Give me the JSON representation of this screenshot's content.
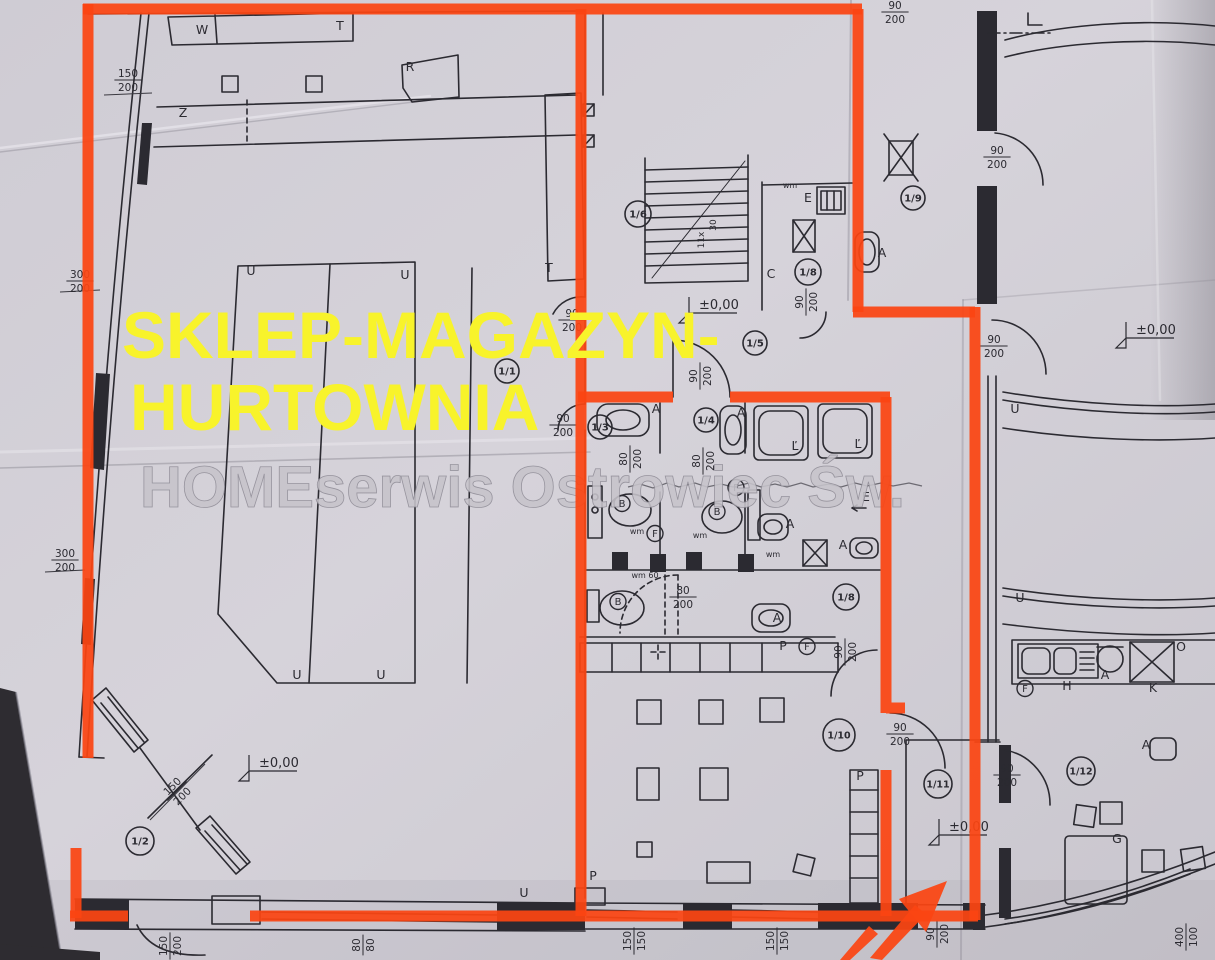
{
  "colors": {
    "paper": "#d4d1d8",
    "ink": "#2b2a31",
    "highlight_orange": "#fb4512",
    "title_yellow": "#f8f32b",
    "watermark_gray": "#c7c4cb"
  },
  "overlay": {
    "title_line1": "SKLEP-MAGAZYN-",
    "title_line2": "HURTOWNIA",
    "watermark": "HOMEserwis Ostrowiec Św."
  },
  "plan": {
    "room_markers": [
      {
        "label": "1/1",
        "x": 507,
        "y": 371,
        "r": 12
      },
      {
        "label": "1/2",
        "x": 140,
        "y": 841,
        "r": 14
      },
      {
        "label": "1/3",
        "x": 600,
        "y": 427,
        "r": 12
      },
      {
        "label": "1/4",
        "x": 706,
        "y": 420,
        "r": 12
      },
      {
        "label": "1/5",
        "x": 755,
        "y": 343,
        "r": 12
      },
      {
        "label": "1/6",
        "x": 638,
        "y": 214,
        "r": 13
      },
      {
        "label": "1/8",
        "x": 808,
        "y": 272,
        "r": 13
      },
      {
        "label": "1/8",
        "x": 846,
        "y": 597,
        "r": 13
      },
      {
        "label": "1/9",
        "x": 913,
        "y": 198,
        "r": 12
      },
      {
        "label": "1/10",
        "x": 839,
        "y": 735,
        "r": 16
      },
      {
        "label": "1/11",
        "x": 938,
        "y": 784,
        "r": 14
      },
      {
        "label": "1/12",
        "x": 1081,
        "y": 771,
        "r": 14
      }
    ],
    "dim_labels": [
      {
        "top": "150",
        "bottom": "200",
        "x": 128,
        "y": 80,
        "rot": 0
      },
      {
        "top": "300",
        "bottom": "200",
        "x": 80,
        "y": 281,
        "rot": 0
      },
      {
        "top": "300",
        "bottom": "200",
        "x": 65,
        "y": 560,
        "rot": 0
      },
      {
        "top": "90",
        "bottom": "200",
        "x": 572,
        "y": 320,
        "rot": 0
      },
      {
        "top": "90",
        "bottom": "200",
        "x": 700,
        "y": 376,
        "rot": -90
      },
      {
        "top": "90",
        "bottom": "200",
        "x": 806,
        "y": 302,
        "rot": -90
      },
      {
        "top": "90",
        "bottom": "200",
        "x": 563,
        "y": 425,
        "rot": 0
      },
      {
        "top": "80",
        "bottom": "200",
        "x": 630,
        "y": 459,
        "rot": -90
      },
      {
        "top": "80",
        "bottom": "200",
        "x": 703,
        "y": 461,
        "rot": -90
      },
      {
        "top": "80",
        "bottom": "200",
        "x": 683,
        "y": 597,
        "rot": 0
      },
      {
        "top": "90",
        "bottom": "200",
        "x": 895,
        "y": 12,
        "rot": 0
      },
      {
        "top": "90",
        "bottom": "200",
        "x": 997,
        "y": 157,
        "rot": 0
      },
      {
        "top": "90",
        "bottom": "200",
        "x": 994,
        "y": 346,
        "rot": 0
      },
      {
        "top": "90",
        "bottom": "200",
        "x": 845,
        "y": 652,
        "rot": -90
      },
      {
        "top": "90",
        "bottom": "200",
        "x": 900,
        "y": 734,
        "rot": 0
      },
      {
        "top": "90",
        "bottom": "200",
        "x": 1007,
        "y": 775,
        "rot": 0
      },
      {
        "top": "150",
        "bottom": "200",
        "x": 177,
        "y": 791,
        "rot": -45
      },
      {
        "top": "150",
        "bottom": "200",
        "x": 170,
        "y": 946,
        "rot": -90
      },
      {
        "top": "80",
        "bottom": "80",
        "x": 363,
        "y": 945,
        "rot": -90
      },
      {
        "top": "150",
        "bottom": "150",
        "x": 634,
        "y": 941,
        "rot": -90
      },
      {
        "top": "150",
        "bottom": "150",
        "x": 777,
        "y": 941,
        "rot": -90
      },
      {
        "top": "90",
        "bottom": "200",
        "x": 937,
        "y": 934,
        "rot": -90
      },
      {
        "top": "400",
        "bottom": "100",
        "x": 1186,
        "y": 937,
        "rot": -90
      }
    ],
    "letters": [
      {
        "t": "W",
        "x": 202,
        "y": 34
      },
      {
        "t": "T",
        "x": 340,
        "y": 30
      },
      {
        "t": "R",
        "x": 410,
        "y": 71
      },
      {
        "t": "Z",
        "x": 183,
        "y": 117
      },
      {
        "t": "T",
        "x": 549,
        "y": 272
      },
      {
        "t": "U",
        "x": 251,
        "y": 275
      },
      {
        "t": "U",
        "x": 405,
        "y": 279
      },
      {
        "t": "U",
        "x": 297,
        "y": 679
      },
      {
        "t": "U",
        "x": 381,
        "y": 679
      },
      {
        "t": "U",
        "x": 524,
        "y": 897
      },
      {
        "t": "U",
        "x": 1015,
        "y": 413
      },
      {
        "t": "U",
        "x": 1020,
        "y": 602
      },
      {
        "t": "C",
        "x": 771,
        "y": 278
      },
      {
        "t": "E",
        "x": 808,
        "y": 202
      },
      {
        "t": "E",
        "x": 866,
        "y": 501
      },
      {
        "t": "P",
        "x": 593,
        "y": 880
      },
      {
        "t": "P",
        "x": 783,
        "y": 650
      },
      {
        "t": "P",
        "x": 860,
        "y": 780
      },
      {
        "t": "A",
        "x": 656,
        "y": 413
      },
      {
        "t": "A",
        "x": 741,
        "y": 417
      },
      {
        "t": "A",
        "x": 790,
        "y": 528
      },
      {
        "t": "A",
        "x": 777,
        "y": 622
      },
      {
        "t": "A",
        "x": 882,
        "y": 257
      },
      {
        "t": "A",
        "x": 843,
        "y": 549
      },
      {
        "t": "A",
        "x": 1105,
        "y": 679
      },
      {
        "t": "A",
        "x": 1146,
        "y": 749
      },
      {
        "t": "G",
        "x": 1117,
        "y": 843
      },
      {
        "t": "H",
        "x": 1067,
        "y": 690
      },
      {
        "t": "K",
        "x": 1153,
        "y": 692
      },
      {
        "t": "O",
        "x": 1181,
        "y": 651
      },
      {
        "t": "Ľ",
        "x": 795,
        "y": 450
      },
      {
        "t": "Ľ",
        "x": 858,
        "y": 448
      }
    ],
    "small_labels": [
      {
        "t": "wm",
        "x": 637,
        "y": 534
      },
      {
        "t": "wm",
        "x": 700,
        "y": 538
      },
      {
        "t": "wm",
        "x": 773,
        "y": 557
      },
      {
        "t": "wm",
        "x": 790,
        "y": 188
      },
      {
        "t": "wm 60",
        "x": 645,
        "y": 578
      }
    ],
    "circled_letters": [
      {
        "t": "F",
        "x": 736,
        "y": 491
      },
      {
        "t": "F",
        "x": 655,
        "y": 537
      },
      {
        "t": "F",
        "x": 807,
        "y": 650
      },
      {
        "t": "F",
        "x": 1025,
        "y": 692
      },
      {
        "t": "B",
        "x": 622,
        "y": 507
      },
      {
        "t": "B",
        "x": 717,
        "y": 515
      },
      {
        "t": "B",
        "x": 618,
        "y": 605
      }
    ],
    "level_marks": [
      {
        "t": "±0,00",
        "x": 245,
        "y": 767
      },
      {
        "t": "±0,00",
        "x": 685,
        "y": 309
      },
      {
        "t": "±0,00",
        "x": 935,
        "y": 831
      },
      {
        "t": "±0,00",
        "x": 1122,
        "y": 334
      }
    ],
    "stair_notes": [
      {
        "t": "30",
        "x": 716,
        "y": 225,
        "rot": -90
      },
      {
        "t": "11x",
        "x": 704,
        "y": 240,
        "rot": -90
      }
    ]
  }
}
